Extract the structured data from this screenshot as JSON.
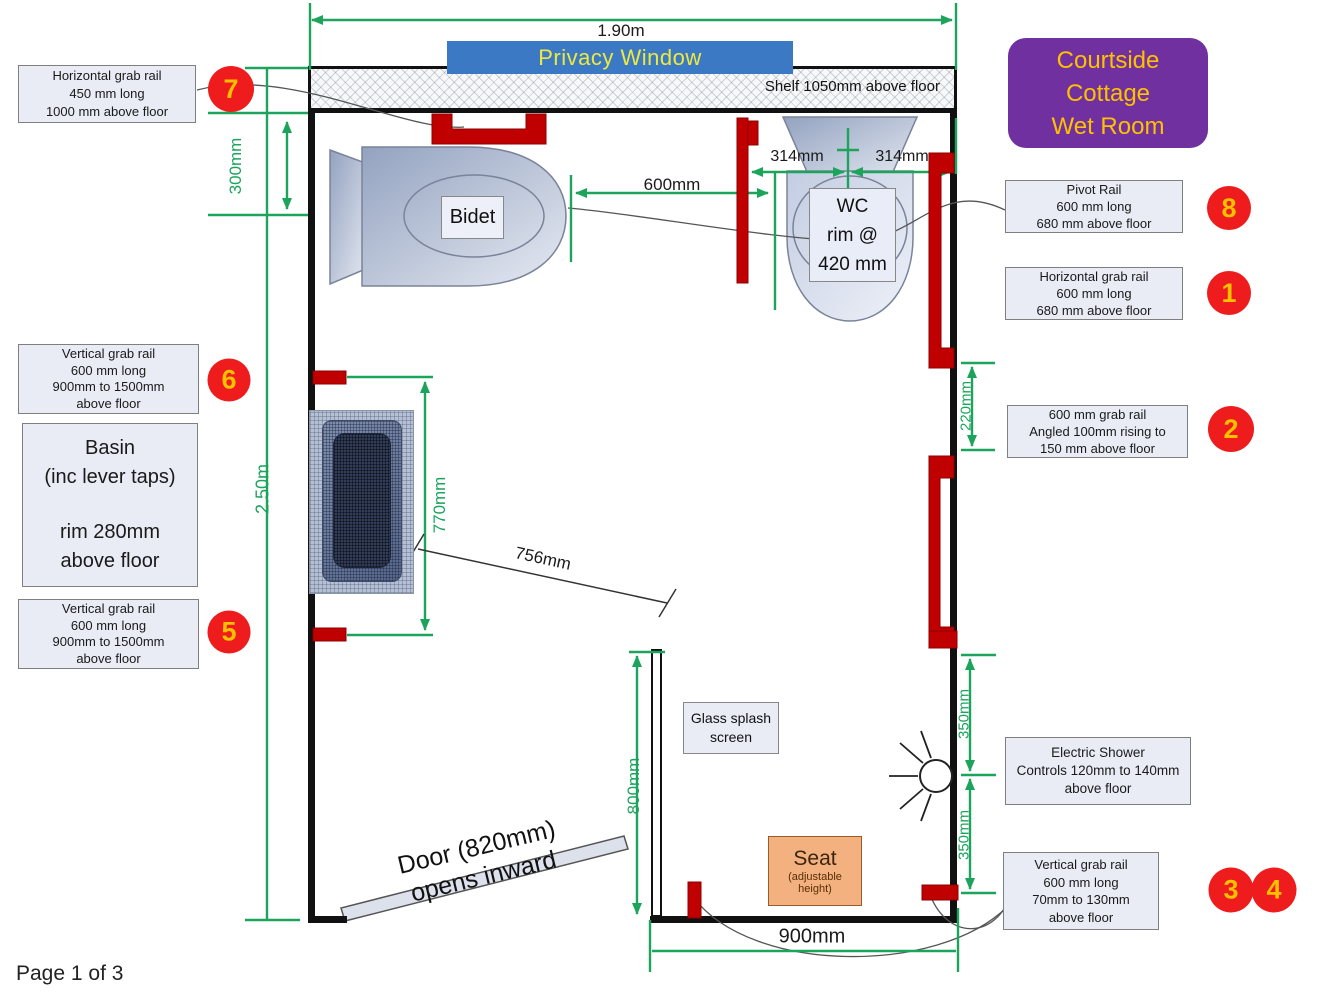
{
  "colors": {
    "dimension_green": "#1CA45C",
    "rail_red": "#C00000",
    "badge_red": "#EE1C1C",
    "badge_text": "#FFC000",
    "title_purple": "#7030A0",
    "banner_blue": "#3B79C4",
    "label_fill": "#E9EBF5",
    "seat_orange": "#F2B17E"
  },
  "header": {
    "width_dim": "1.90m",
    "privacy_window": "Privacy Window",
    "shelf_label": "Shelf 1050mm above floor"
  },
  "title_card": {
    "line1": "Courtside",
    "line2": "Cottage",
    "line3": "Wet Room"
  },
  "dims": {
    "d300": "300mm",
    "d250": "2.50m",
    "d600": "600mm",
    "d314a": "314mm",
    "d314b": "314mm",
    "d770": "770mm",
    "d756": "756mm",
    "d220": "220mm",
    "d350a": "350mm",
    "d350b": "350mm",
    "d800": "800mm",
    "d900": "900mm"
  },
  "fixtures": {
    "bidet_label": "Bidet",
    "wc": {
      "l1": "WC",
      "l2": "rim @",
      "l3": "420 mm"
    },
    "glass": {
      "l1": "Glass splash",
      "l2": "screen"
    },
    "seat": {
      "l1": "Seat",
      "l2": "(adjustable",
      "l3": "height)"
    },
    "door": {
      "l1": "Door (820mm)",
      "l2": "opens inward"
    },
    "basin_note": {
      "l1": "Basin",
      "l2": "(inc lever taps)",
      "l3": "rim 280mm",
      "l4": "above floor"
    }
  },
  "callouts": {
    "grab7": {
      "badge": "7",
      "l1": "Horizontal grab rail",
      "l2": "450 mm long",
      "l3": "1000 mm above floor"
    },
    "grab6": {
      "badge": "6",
      "l1": "Vertical grab rail",
      "l2": "600 mm long",
      "l3": "900mm to 1500mm",
      "l4": "above floor"
    },
    "grab5": {
      "badge": "5",
      "l1": "Vertical grab rail",
      "l2": "600 mm long",
      "l3": "900mm to 1500mm",
      "l4": "above floor"
    },
    "pivot8": {
      "badge": "8",
      "l1": "Pivot Rail",
      "l2": "600 mm long",
      "l3": "680 mm above floor"
    },
    "grab1": {
      "badge": "1",
      "l1": "Horizontal grab rail",
      "l2": "600 mm long",
      "l3": "680 mm above floor"
    },
    "grab2": {
      "badge": "2",
      "l1": "600 mm grab rail",
      "l2": "Angled 100mm rising to",
      "l3": "150 mm above floor"
    },
    "shower": {
      "l1": "Electric Shower",
      "l2": "Controls 120mm to 140mm",
      "l3": "above floor"
    },
    "grab34": {
      "badge_a": "3",
      "badge_b": "4",
      "l1": "Vertical grab rail",
      "l2": "600 mm long",
      "l3": "70mm to 130mm",
      "l4": "above floor"
    }
  },
  "footer": {
    "page": "Page 1 of 3"
  }
}
